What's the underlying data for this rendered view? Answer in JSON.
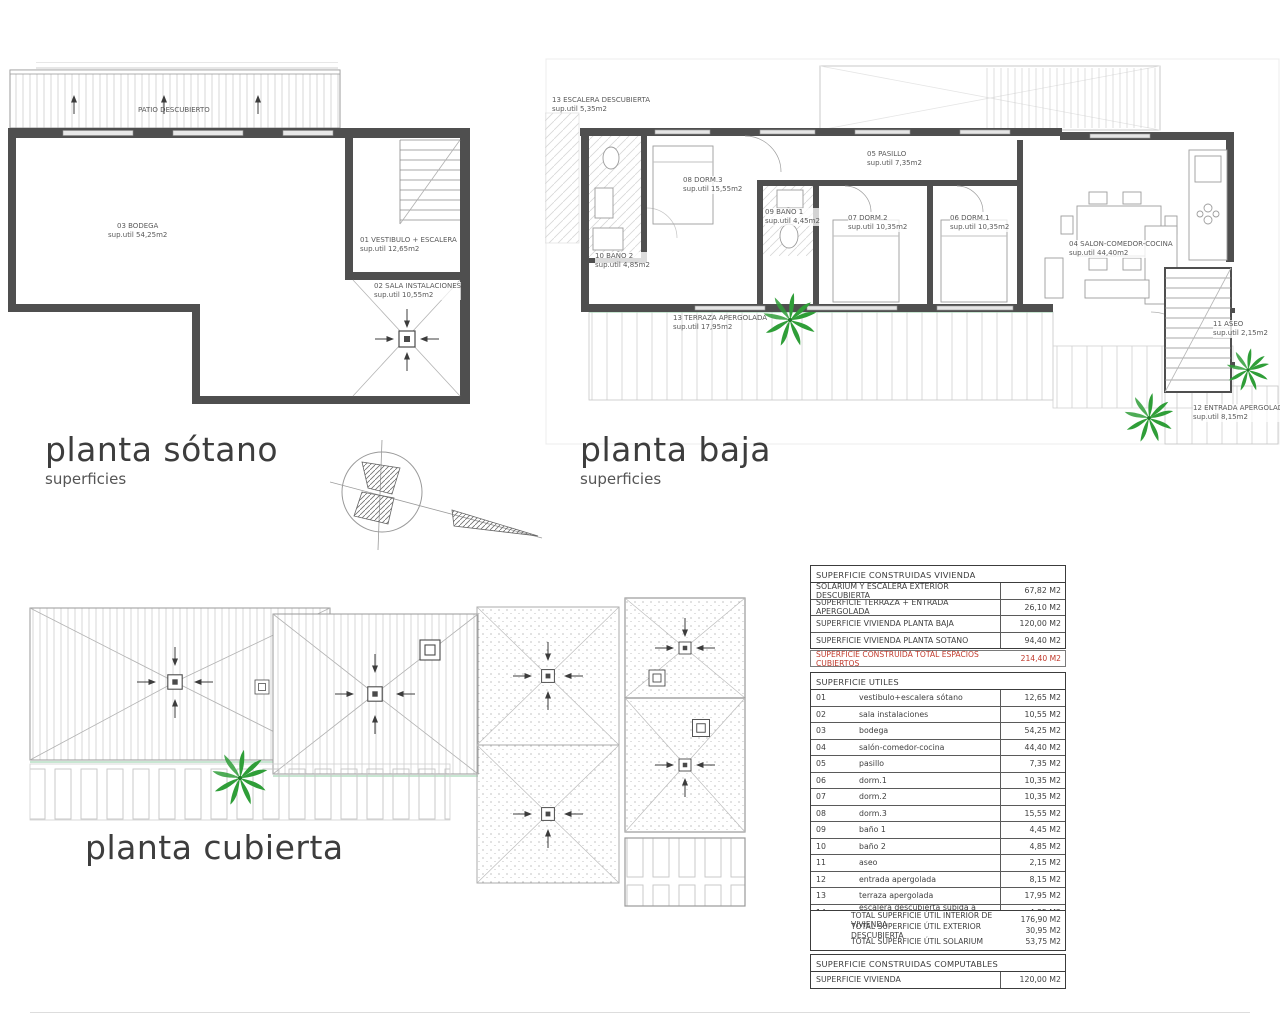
{
  "colors": {
    "palm_green": "#2f9e38",
    "total_red": "#c0392b",
    "wall_gray": "#4f4f4f"
  },
  "plans": {
    "sotano": {
      "title": "planta sótano",
      "subtitle": "superficies",
      "patio_label": "PATIO DESCUBIERTO",
      "rooms": [
        {
          "name": "03 BODEGA",
          "area": "sup.util 54,25m2"
        },
        {
          "name": "01 VESTIBULO + ESCALERA",
          "area": "sup.util 12,65m2"
        },
        {
          "name": "02 SALA INSTALACIONES",
          "area": "sup.util 10,55m2"
        }
      ]
    },
    "baja": {
      "title": "planta baja",
      "subtitle": "superficies",
      "rooms": [
        {
          "name": "13 ESCALERA DESCUBIERTA",
          "area": "sup.util 5,35m2"
        },
        {
          "name": "08 DORM.3",
          "area": "sup.util 15,55m2"
        },
        {
          "name": "09 BAÑO 1",
          "area": "sup.util 4,45m2"
        },
        {
          "name": "07 DORM.2",
          "area": "sup.util 10,35m2"
        },
        {
          "name": "06 DORM.1",
          "area": "sup.util 10,35m2"
        },
        {
          "name": "05 PASILLO",
          "area": "sup.util 7,35m2"
        },
        {
          "name": "04 SALON-COMEDOR-COCINA",
          "area": "sup.util 44,40m2"
        },
        {
          "name": "10 BAÑO 2",
          "area": "sup.util 4,85m2"
        },
        {
          "name": "13 TERRAZA APERGOLADA",
          "area": "sup.util 17,95m2"
        },
        {
          "name": "11 ASEO",
          "area": "sup.util 2,15m2"
        },
        {
          "name": "12 ENTRADA APERGOLADA",
          "area": "sup.util 8,15m2"
        }
      ]
    },
    "cubierta": {
      "title": "planta cubierta"
    }
  },
  "tables": {
    "constructed": {
      "header": "SUPERFICIE CONSTRUIDAS VIVIENDA",
      "rows": [
        {
          "label": "SOLARIUM Y ESCALERA EXTERIOR DESCUBIERTA",
          "value": "67,82 M2"
        },
        {
          "label": "SUPERFICIE TERRAZA + ENTRADA APERGOLADA",
          "value": "26,10 M2"
        },
        {
          "label": "SUPERFICIE VIVIENDA PLANTA BAJA",
          "value": "120,00 M2"
        },
        {
          "label": "SUPERFICIE VIVIENDA PLANTA SOTANO",
          "value": "94,40 M2"
        }
      ],
      "total": {
        "label": "SUPERFICIE CONSTRUIDA TOTAL ESPACIOS CUBIERTOS",
        "value": "214,40 M2"
      }
    },
    "useful": {
      "header": "SUPERFICIE UTILES",
      "rows": [
        {
          "num": "01",
          "label": "vestibulo+escalera sótano",
          "value": "12,65 M2"
        },
        {
          "num": "02",
          "label": "sala instalaciones",
          "value": "10,55 M2"
        },
        {
          "num": "03",
          "label": "bodega",
          "value": "54,25 M2"
        },
        {
          "num": "04",
          "label": "salón-comedor-cocina",
          "value": "44,40 M2"
        },
        {
          "num": "05",
          "label": "pasillo",
          "value": "7,35 M2"
        },
        {
          "num": "06",
          "label": "dorm.1",
          "value": "10,35 M2"
        },
        {
          "num": "07",
          "label": "dorm.2",
          "value": "10,35 M2"
        },
        {
          "num": "08",
          "label": "dorm.3",
          "value": "15,55 M2"
        },
        {
          "num": "09",
          "label": "baño 1",
          "value": "4,45 M2"
        },
        {
          "num": "10",
          "label": "baño 2",
          "value": "4,85 M2"
        },
        {
          "num": "11",
          "label": "aseo",
          "value": "2,15 M2"
        },
        {
          "num": "12",
          "label": "entrada apergolada",
          "value": "8,15 M2"
        },
        {
          "num": "13",
          "label": "terraza apergolada",
          "value": "17,95 M2"
        },
        {
          "num": "14",
          "label": "escalera descubierta subida a solarium",
          "value": "4,85 M2"
        }
      ],
      "totals": [
        {
          "label": "TOTAL SUPERFICIE ÚTIL INTERIOR DE VIVIENDA",
          "value": "176,90 M2"
        },
        {
          "label": "TOTAL SUPERFICIE ÚTIL EXTERIOR DESCUBIERTA",
          "value": "30,95 M2"
        },
        {
          "label": "TOTAL SUPERFICIE ÚTIL SOLARIUM",
          "value": "53,75 M2"
        }
      ]
    },
    "computable": {
      "header": "SUPERFICIE CONSTRUIDAS COMPUTABLES",
      "rows": [
        {
          "label": "SUPERFICIE VIVIENDA",
          "value": "120,00 M2"
        }
      ]
    }
  }
}
